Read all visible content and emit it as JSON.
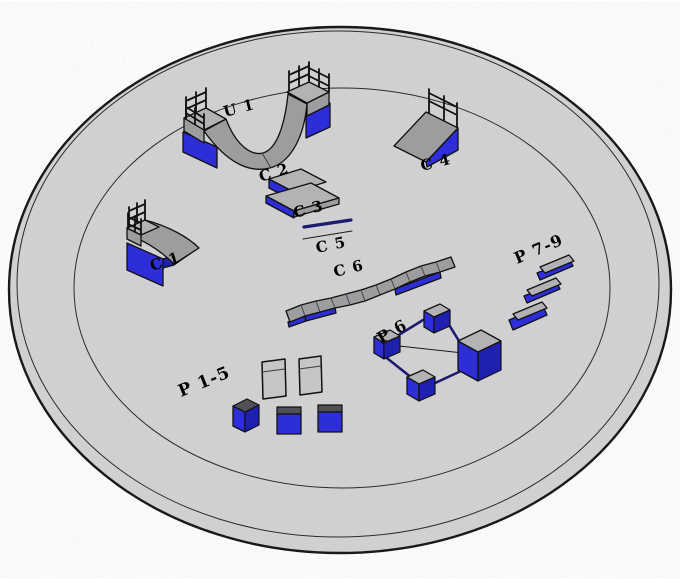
{
  "colors": {
    "ground": "#d3d3d5",
    "gray_top": "#b3b3b5",
    "gray_mid": "#9d9da0",
    "gray_dark": "#515155",
    "gray_light": "#c6c6c8",
    "blue": "#2e2ed8",
    "blue_dark": "#2020b0",
    "navy": "#1c1c6e",
    "outline": "#111111"
  },
  "obstacles": {
    "u1": {
      "label": "U 1"
    },
    "c1": {
      "label": "C 1"
    },
    "c2": {
      "label": "C 2"
    },
    "c3": {
      "label": "C 3"
    },
    "c4": {
      "label": "C 4"
    },
    "c5": {
      "label": "C 5"
    },
    "c6": {
      "label": "C 6"
    },
    "p1_5": {
      "label": "P 1-5"
    },
    "p6": {
      "label": "P 6"
    },
    "p7_9": {
      "label": "P 7-9"
    }
  }
}
